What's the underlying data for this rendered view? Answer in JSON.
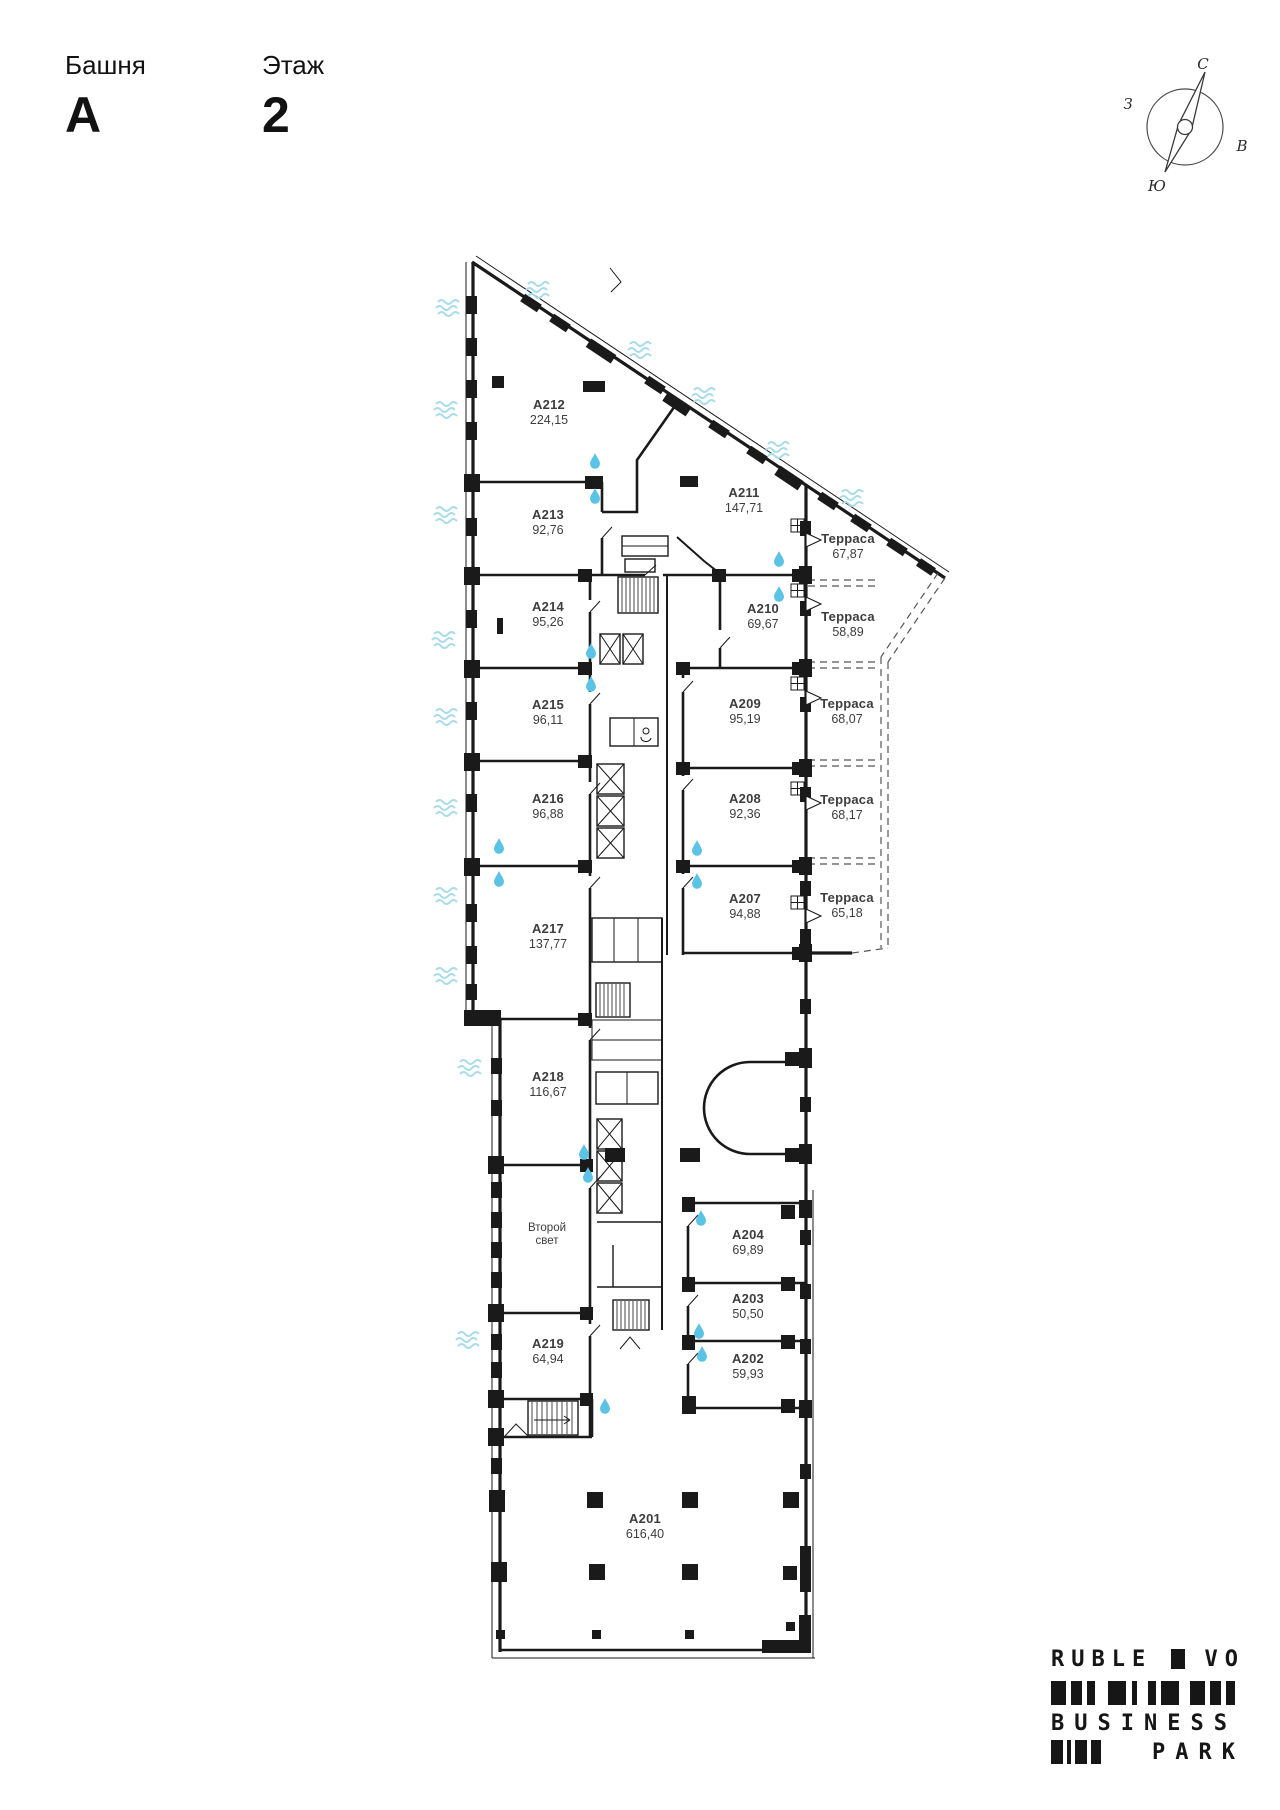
{
  "header": {
    "tower_label": "Башня",
    "tower_value": "A",
    "floor_label": "Этаж",
    "floor_value": "2"
  },
  "compass": {
    "north": "С",
    "east": "В",
    "south": "Ю",
    "west": "З"
  },
  "plan": {
    "rooms": [
      {
        "id": "A212",
        "area": "224,15"
      },
      {
        "id": "A213",
        "area": "92,76"
      },
      {
        "id": "A214",
        "area": "95,26"
      },
      {
        "id": "A215",
        "area": "96,11"
      },
      {
        "id": "A216",
        "area": "96,88"
      },
      {
        "id": "A217",
        "area": "137,77"
      },
      {
        "id": "A218",
        "area": "116,67"
      },
      {
        "id": "A219",
        "area": "64,94"
      },
      {
        "id": "A211",
        "area": "147,71"
      },
      {
        "id": "A210",
        "area": "69,67"
      },
      {
        "id": "A209",
        "area": "95,19"
      },
      {
        "id": "A208",
        "area": "92,36"
      },
      {
        "id": "A207",
        "area": "94,88"
      },
      {
        "id": "A204",
        "area": "69,89"
      },
      {
        "id": "A203",
        "area": "50,50"
      },
      {
        "id": "A202",
        "area": "59,93"
      },
      {
        "id": "A201",
        "area": "616,40"
      }
    ],
    "terraces": [
      {
        "name": "Терраса",
        "area": "67,87"
      },
      {
        "name": "Терраса",
        "area": "58,89"
      },
      {
        "name": "Терраса",
        "area": "68,07"
      },
      {
        "name": "Терраса",
        "area": "68,17"
      },
      {
        "name": "Терраса",
        "area": "65,18"
      }
    ],
    "second_light": {
      "line1": "Второй",
      "line2": "свет"
    }
  },
  "logo": {
    "word1": "RUBLE",
    "word2": "VO",
    "word3": "BUSINESS",
    "word4": "PARK"
  },
  "colors": {
    "walls": "#1a1a1a",
    "water_drop": "#5bc3e5",
    "water_waves": "#a9dce9"
  }
}
